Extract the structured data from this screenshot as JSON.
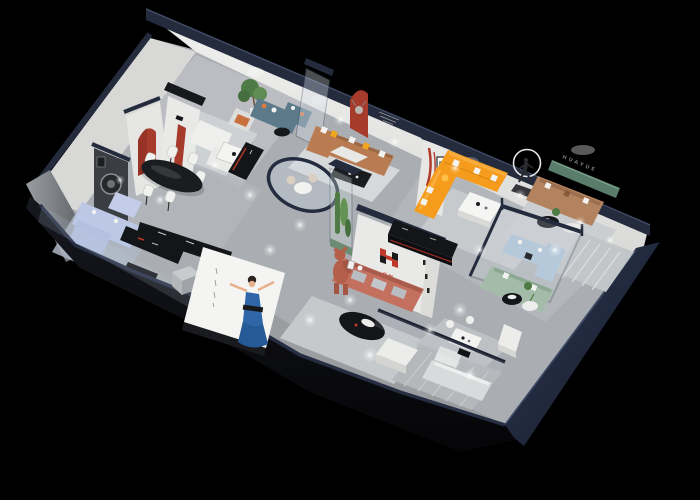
{
  "scene": {
    "kind": "isometric-3d-furniture-showroom-cutaway-render",
    "background": "#000000"
  },
  "brand": {
    "logo_text": "华悦",
    "wall_letters": "HUAYUE",
    "logo_red": "#c0392b",
    "logo_black": "#1a1a1a"
  },
  "colors": {
    "navy_wall": "#232b3d",
    "navy_dark": "#1b2232",
    "white_wall": "#e9e9e7",
    "wall_shade": "#d8d8d6",
    "floor": "#aaadb2",
    "rug_light": "#d0d2d4",
    "accent_red": "#a63a2b",
    "orange_sofa": "#f59c1d",
    "tan_sofa": "#b97c52",
    "leather_sofa": "#b3825e",
    "salmon_sofa": "#c4705f",
    "periwinkle_sofa": "#bcc8e6",
    "teal_sofa": "#5c7a8a",
    "sage_sofa": "#a3bba8",
    "skyblue_sofa": "#b6c9da",
    "pale_sofa": "#d9dadb",
    "green_panel": "#5a7c6a",
    "plant_green": "#4d7a45",
    "bear_clay": "#b35f4a",
    "dress_blue": "#2e66a8",
    "black_furniture": "#17181b"
  },
  "areas": [
    {
      "id": "lounge-top-left",
      "feature": "white-sofa-set-teal-sofa-tree"
    },
    {
      "id": "dining-area",
      "feature": "black-oval-table-white-chairs"
    },
    {
      "id": "living-tan-sectional",
      "feature": "red-arch-niche-deer-bust"
    },
    {
      "id": "living-orange-sectional",
      "feature": "runner-sculpture-light-ring"
    },
    {
      "id": "lounge-huayue-wall",
      "feature": "green-panel-letters"
    },
    {
      "id": "logo-feature-wall",
      "feature": "brand-logo-salmon-sofa"
    },
    {
      "id": "glass-plant-column",
      "feature": "cactus-display"
    },
    {
      "id": "glass-meeting-pod",
      "feature": "round-table"
    },
    {
      "id": "glass-box-sofas",
      "feature": "skyblue-and-sage-sofas"
    },
    {
      "id": "periwinkle-lounge",
      "feature": "black-media-consoles"
    },
    {
      "id": "front-billboard",
      "feature": "woman-in-blue-dress-screen"
    },
    {
      "id": "mascot",
      "feature": "clay-bear-figure"
    }
  ]
}
